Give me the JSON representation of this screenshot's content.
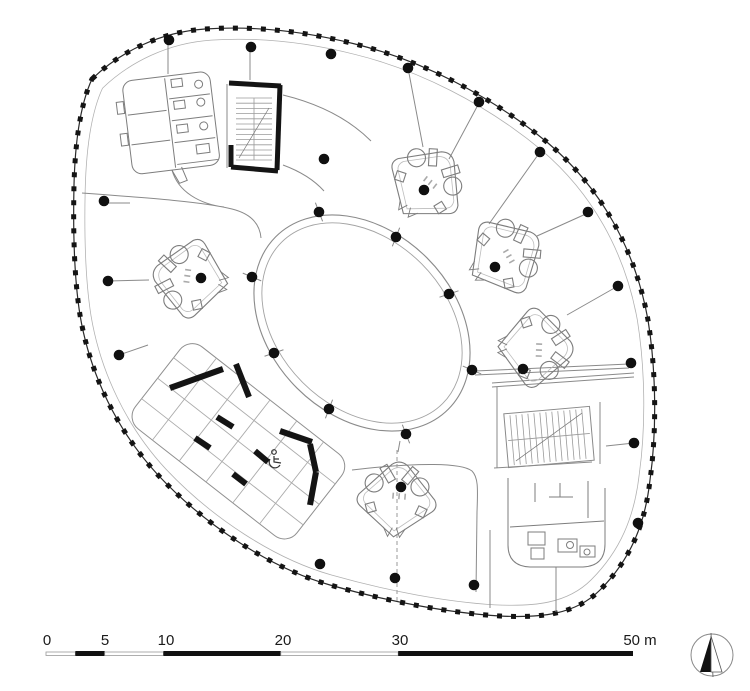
{
  "drawing": {
    "kind_label": "floor-plan",
    "background": "#ffffff"
  },
  "colors": {
    "ink": "#141414",
    "wall_thin": "#7d7d7d",
    "wall_light": "#a3a3a3",
    "dot": "#101010",
    "scalebar_black": "#111111",
    "scalebar_white": "#ffffff",
    "scalebar_outline": "#9a9a9a",
    "label_text": "#1a1a1a"
  },
  "scalebar": {
    "origin_px": 46,
    "px_per_m": 11.74,
    "bar_y": 651,
    "label_y": 645,
    "font_size": 15,
    "labels": [
      {
        "t": "0",
        "x": 47
      },
      {
        "t": "5",
        "x": 105
      },
      {
        "t": "10",
        "x": 166
      },
      {
        "t": "20",
        "x": 283
      },
      {
        "t": "30",
        "x": 400
      },
      {
        "t": "50 m",
        "x": 640
      }
    ],
    "segments": [
      {
        "a": 0,
        "b": 2.5,
        "black": false
      },
      {
        "a": 2.5,
        "b": 5,
        "black": true
      },
      {
        "a": 5,
        "b": 10,
        "black": false
      },
      {
        "a": 10,
        "b": 20,
        "black": true
      },
      {
        "a": 20,
        "b": 30,
        "black": false
      },
      {
        "a": 30,
        "b": 50,
        "black": true
      }
    ]
  },
  "compass": {
    "cx": 712,
    "cy": 655,
    "r": 21
  },
  "plan": {
    "core_center": {
      "x": 362,
      "y": 323
    },
    "core_oval": {
      "cx": 362,
      "cy": 323,
      "rx": 122,
      "ry": 92,
      "rx_inner": 114,
      "ry_inner": 84,
      "rotation": 45
    },
    "dot_radius": 5.3,
    "dots": {
      "perimeter_columns": [
        [
          169,
          40
        ],
        [
          251,
          47
        ],
        [
          331,
          54
        ],
        [
          408,
          68
        ],
        [
          479,
          102
        ],
        [
          540,
          152
        ],
        [
          588,
          212
        ],
        [
          618,
          286
        ],
        [
          631,
          363
        ],
        [
          634,
          443
        ],
        [
          638,
          523
        ],
        [
          474,
          585
        ],
        [
          395,
          578
        ],
        [
          320,
          564
        ],
        [
          119,
          355
        ],
        [
          108,
          281
        ],
        [
          104,
          201
        ]
      ],
      "ring_columns": [
        [
          319,
          212
        ],
        [
          396,
          237
        ],
        [
          449,
          294
        ],
        [
          472,
          370
        ],
        [
          406,
          434
        ],
        [
          329,
          409
        ],
        [
          274,
          353
        ],
        [
          252,
          277
        ]
      ],
      "pod_columns": [
        [
          201,
          278
        ],
        [
          424,
          190
        ],
        [
          495,
          267
        ],
        [
          523,
          369
        ],
        [
          401,
          487
        ]
      ],
      "corridor_columns": [
        [
          324,
          159
        ]
      ]
    },
    "black_walls": [
      {
        "x1": 229,
        "y1": 83,
        "x2": 281,
        "y2": 86,
        "w": 5
      },
      {
        "x1": 280,
        "y1": 85,
        "x2": 277,
        "y2": 170,
        "w": 5
      },
      {
        "x1": 231,
        "y1": 167,
        "x2": 278,
        "y2": 171,
        "w": 5
      },
      {
        "x1": 231,
        "y1": 145,
        "x2": 231,
        "y2": 167,
        "w": 5
      },
      {
        "x1": 170,
        "y1": 388,
        "x2": 223,
        "y2": 369,
        "w": 6
      },
      {
        "x1": 236,
        "y1": 364,
        "x2": 249,
        "y2": 397,
        "w": 6
      },
      {
        "x1": 217,
        "y1": 417,
        "x2": 233,
        "y2": 427,
        "w": 6
      },
      {
        "x1": 195,
        "y1": 438,
        "x2": 210,
        "y2": 448,
        "w": 6
      },
      {
        "x1": 255,
        "y1": 451,
        "x2": 268,
        "y2": 462,
        "w": 6
      },
      {
        "x1": 233,
        "y1": 474,
        "x2": 246,
        "y2": 484,
        "w": 6
      },
      {
        "x1": 280,
        "y1": 431,
        "x2": 312,
        "y2": 442,
        "w": 6
      },
      {
        "x1": 310,
        "y1": 444,
        "x2": 316,
        "y2": 472,
        "w": 6
      },
      {
        "x1": 316,
        "y1": 472,
        "x2": 310,
        "y2": 505,
        "w": 6
      }
    ],
    "pods": [
      {
        "name": "wc-pod-left",
        "x": 188,
        "y": 278,
        "rot": 8
      },
      {
        "name": "wc-pod-top-right",
        "x": 428,
        "y": 182,
        "rot": 128
      },
      {
        "name": "wc-pod-right-upper",
        "x": 507,
        "y": 255,
        "rot": 150
      },
      {
        "name": "wc-pod-right-lower",
        "x": 538,
        "y": 348,
        "rot": 182
      },
      {
        "name": "wc-pod-bottom",
        "x": 397,
        "y": 497,
        "rot": 95
      }
    ]
  }
}
